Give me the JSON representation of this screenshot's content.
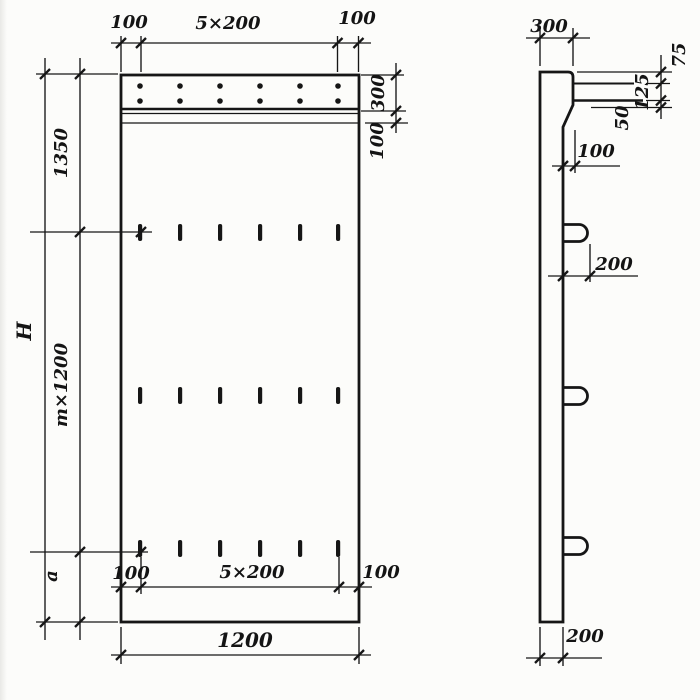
{
  "drawing": {
    "type": "engineering-drawing",
    "views": [
      "front elevation",
      "side section"
    ],
    "front_view": {
      "top_dim": {
        "left": "100",
        "middle": "5×200",
        "right": "100"
      },
      "right_dim": {
        "strip_height": "300",
        "groove_height": "100"
      },
      "left_dim": {
        "upper": "1350",
        "middle": "m×1200",
        "lower": "a",
        "overall_height": "H"
      },
      "bottom_inner_dim": {
        "left": "100",
        "middle": "5×200",
        "right": "100"
      },
      "overall_width": "1200"
    },
    "side_view": {
      "top_thickness": "300",
      "right_dim": {
        "top": "75",
        "middle": "125",
        "bottom": "50"
      },
      "edge_offset": "100",
      "loop_depth": "200",
      "bottom_thickness": "200"
    },
    "colors": {
      "ink": "#161616",
      "paper": "#fcfcfa"
    }
  }
}
